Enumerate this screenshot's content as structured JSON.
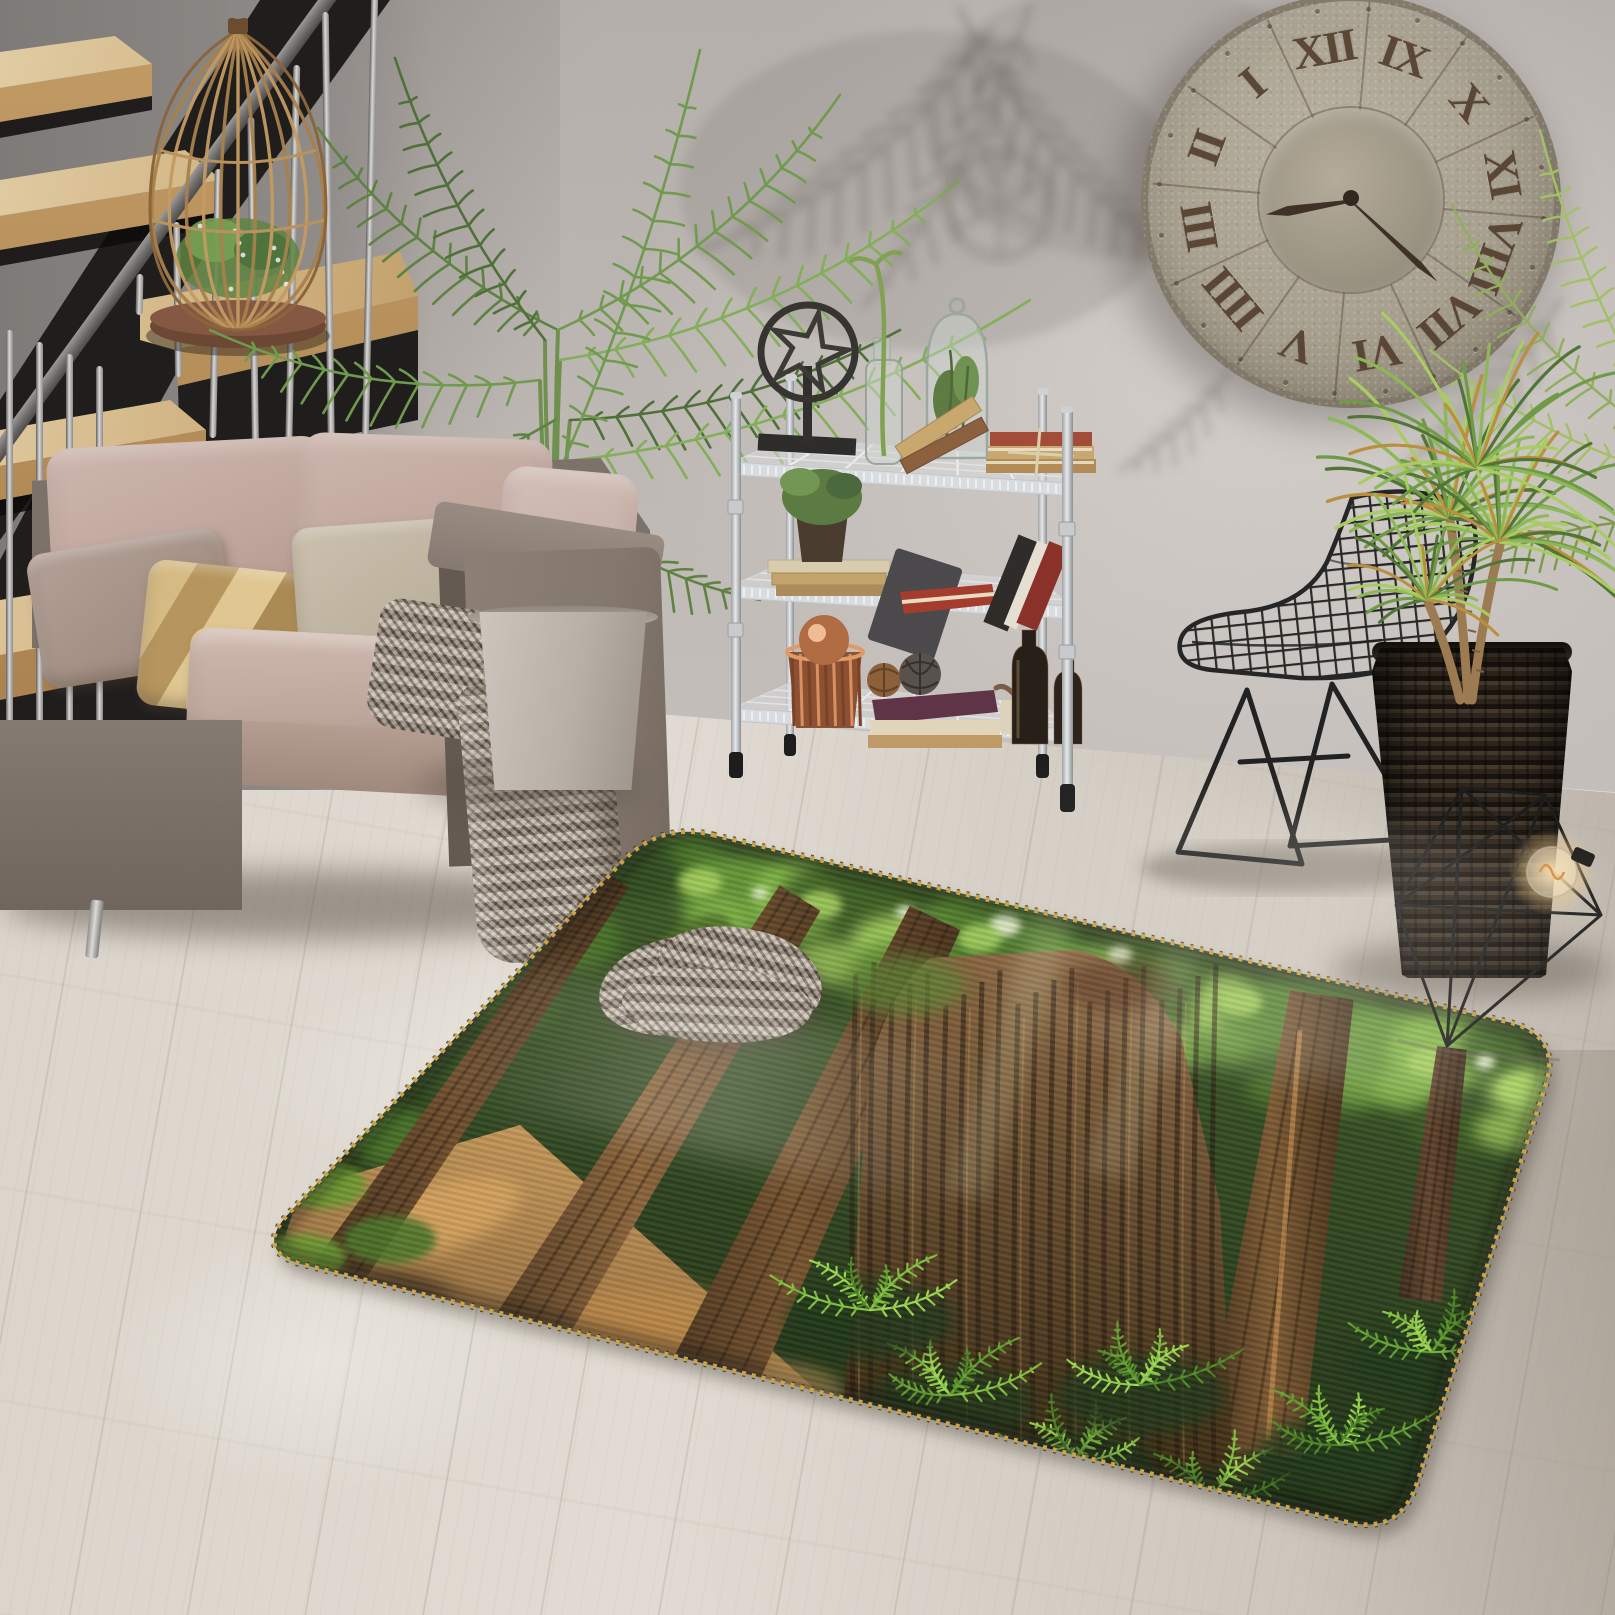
{
  "scene": {
    "description": "Living room product photo of a 3D redwood forest print area rug with stitched gold edge, on a whitewashed wood plank floor against a gray stucco wall",
    "objects": [
      {
        "id": "staircase",
        "label": "wooden open-tread staircase with black stringer and steel rod balusters"
      },
      {
        "id": "cage-planter",
        "label": "rattan birdcage planter with green plant"
      },
      {
        "id": "sofa",
        "label": "gray-brown tweed sofa with blush pink cushions and pillows"
      },
      {
        "id": "throw-blanket",
        "label": "herringbone throw blanket draped to the floor"
      },
      {
        "id": "kentia-palm",
        "label": "kentia palm in a tapered concrete pot"
      },
      {
        "id": "wire-shelf",
        "label": "3-tier chrome wire shelf with books, bottles, copper basket and decor"
      },
      {
        "id": "wall-clock",
        "label": "oversized rustic metal wall clock with roman numerals"
      },
      {
        "id": "wire-chair",
        "label": "black wire grid side chair"
      },
      {
        "id": "rattan-planter",
        "label": "dark woven rattan planter with dracaena plant"
      },
      {
        "id": "wire-diamond",
        "label": "geometric diamond wire decor with edison bulb"
      },
      {
        "id": "area-rug",
        "label": "3D redwood forest trees print rug with rounded corners and blanket-stitched edge"
      },
      {
        "id": "floor",
        "label": "whitewashed wood plank floor"
      },
      {
        "id": "wall",
        "label": "gray stucco wall with palm leaf shadows"
      }
    ],
    "palette": {
      "wall": "#c3bdb9",
      "wall_shadow": "#6e6a68",
      "floor": "#dcd6cd",
      "floor_shade": "#bfb7ad",
      "stair_wood": "#c9a873",
      "stair_stringer": "#1d1b1a",
      "steel": "#d9d8d6",
      "sofa_frame": "#83776d",
      "sofa_cushion": "#c0a79d",
      "pillow_gold": "#c9a869",
      "throw": "#988b7e",
      "concrete_pot": "#b8b0a7",
      "palm_green": "#6f9a4c",
      "shelf_chrome": "#dcdfe1",
      "book_red": "#a43a2c",
      "book_tan": "#c8a770",
      "copper": "#d98f5e",
      "clock_metal": "#a79f8e",
      "clock_numeral": "#4e3827",
      "chair_wire": "#232323",
      "rattan": "#2b221a",
      "dracaena_green": "#6e9a44",
      "rug_canopy_green": "#6fa03b",
      "rug_trunk_brown": "#8a6238",
      "rug_fern": "#82c23d",
      "rug_path_sunlit": "#c89a58",
      "rug_stitch": "#c9a44b"
    }
  },
  "clock": {
    "numerals_clockwise_from_top": [
      "XII",
      "IX",
      "X",
      "XI",
      "VIII",
      "VII",
      "VI",
      "V",
      "IIII",
      "III",
      "II",
      "I"
    ],
    "style": "roman",
    "hands": {
      "hour_angle_deg": -99,
      "minute_angle_deg": 133
    }
  }
}
